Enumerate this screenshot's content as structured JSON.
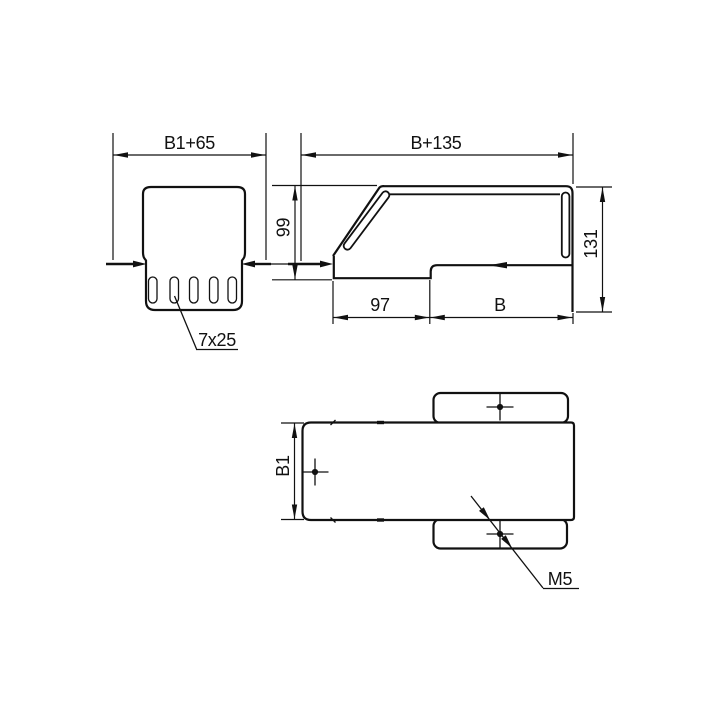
{
  "page": {
    "background": "#ffffff",
    "line_color": "#111111",
    "description": "Technical drawing of a cable tray reducer / end piece in three orthographic views"
  },
  "front_view": {
    "width_dim": "B1+65",
    "slots_label": "7x25",
    "slot_count": 5
  },
  "side_view": {
    "width_dim": "B+135",
    "left_height_dim": "99",
    "right_height_dim": "131",
    "bottom_left_dim": "97",
    "bottom_right_dim": "B"
  },
  "plan_view": {
    "height_dim": "B1",
    "thread_label": "M5",
    "center_mark_count": 3
  }
}
